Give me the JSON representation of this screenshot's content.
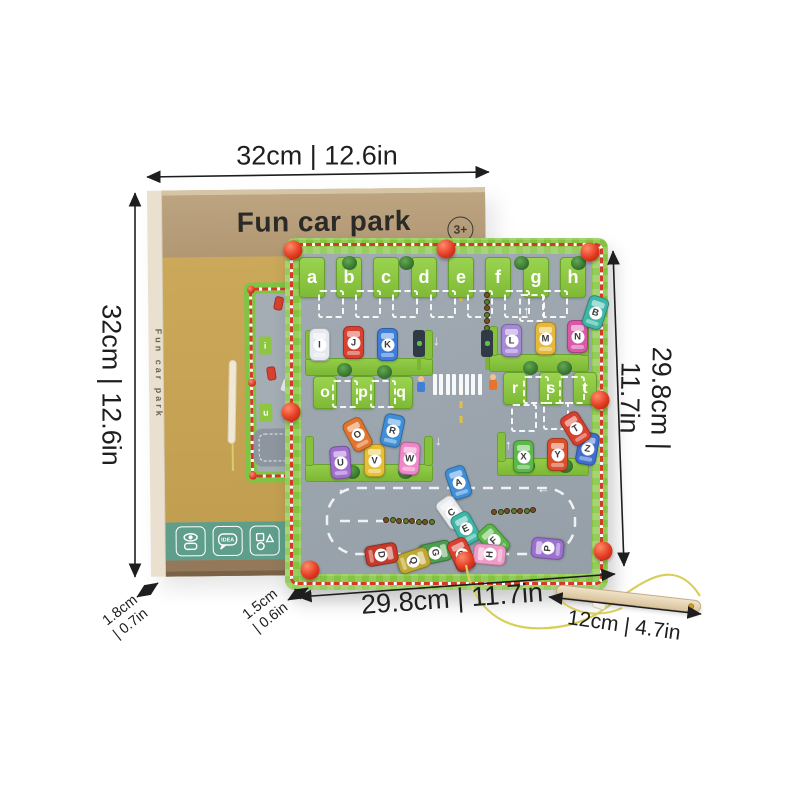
{
  "box": {
    "title": "Fun car park",
    "side_title": "Fun car park",
    "age_badge": "3+",
    "mini_board_letters": [
      "i",
      "u"
    ],
    "icons": [
      {
        "name": "eye-and-toy-icon"
      },
      {
        "name": "idea-bubble-icon",
        "label": "IDEA"
      },
      {
        "name": "shapes-icon"
      },
      {
        "name": "math-symbols-icon",
        "line1": "+ −",
        "line2": "× ÷"
      }
    ]
  },
  "dimensions": {
    "width_top": "32cm | 12.6in",
    "height_left": "32cm | 12.6in",
    "board_height_right": "29.8cm | 11.7in",
    "board_width_bottom": "29.8cm | 11.7in",
    "wand_length": "12cm | 4.7in",
    "box_depth": "1.8cm\n| 0.7in",
    "board_depth": "1.5cm\n| 0.6in"
  },
  "board": {
    "top_letters": [
      "a",
      "b",
      "c",
      "d",
      "e",
      "f",
      "g",
      "h"
    ],
    "left_slot_letters": [
      "o",
      "p",
      "q"
    ],
    "right_slot_letters": [
      "r",
      "s",
      "t"
    ],
    "cars": [
      {
        "letter": "I",
        "color": "#e6e9ef",
        "x": 24,
        "y": 90,
        "rot": 0
      },
      {
        "letter": "J",
        "color": "#d8412f",
        "x": 58,
        "y": 88,
        "rot": 0
      },
      {
        "letter": "K",
        "color": "#3f7ed8",
        "x": 92,
        "y": 90,
        "rot": 0
      },
      {
        "letter": "L",
        "color": "#a78ad6",
        "x": 216,
        "y": 86,
        "rot": 0
      },
      {
        "letter": "M",
        "color": "#e7b93b",
        "x": 250,
        "y": 84,
        "rot": 0
      },
      {
        "letter": "N",
        "color": "#d958a9",
        "x": 282,
        "y": 82,
        "rot": 0
      },
      {
        "letter": "U",
        "color": "#a06ecf",
        "x": 45,
        "y": 208,
        "rot": -4
      },
      {
        "letter": "V",
        "color": "#e7c133",
        "x": 79,
        "y": 206,
        "rot": 0
      },
      {
        "letter": "W",
        "color": "#ef87c8",
        "x": 114,
        "y": 204,
        "rot": 4
      },
      {
        "letter": "X",
        "color": "#5cb84a",
        "x": 228,
        "y": 202,
        "rot": 0
      },
      {
        "letter": "Y",
        "color": "#d9512c",
        "x": 262,
        "y": 200,
        "rot": 0
      },
      {
        "letter": "Z",
        "color": "#3f6ed0",
        "x": 292,
        "y": 194,
        "rot": 10
      },
      {
        "letter": "O",
        "color": "#e0762e",
        "x": 62,
        "y": 180,
        "rot": -28
      },
      {
        "letter": "R",
        "color": "#3f8ed8",
        "x": 97,
        "y": 176,
        "rot": 12
      },
      {
        "letter": "T",
        "color": "#d8402e",
        "x": 280,
        "y": 174,
        "rot": -32
      },
      {
        "letter": "B",
        "color": "#3fb7a7",
        "x": 300,
        "y": 58,
        "rot": 18
      },
      {
        "letter": "A",
        "color": "#3f8ed8",
        "x": 163,
        "y": 228,
        "rot": -18
      },
      {
        "letter": "C",
        "color": "#e8ebee",
        "x": 156,
        "y": 258,
        "rot": -35
      },
      {
        "letter": "E",
        "color": "#3fb7a7",
        "x": 170,
        "y": 274,
        "rot": -28
      },
      {
        "letter": "F",
        "color": "#5cb84a",
        "x": 198,
        "y": 286,
        "rot": -42
      },
      {
        "letter": "G",
        "color": "#4a9e4e",
        "x": 140,
        "y": 298,
        "rot": 78
      },
      {
        "letter": "S",
        "color": "#d8412f",
        "x": 166,
        "y": 300,
        "rot": -25
      },
      {
        "letter": "H",
        "color": "#ef9bc8",
        "x": 194,
        "y": 300,
        "rot": -85
      },
      {
        "letter": "Q",
        "color": "#bfa733",
        "x": 118,
        "y": 306,
        "rot": 72
      },
      {
        "letter": "D",
        "color": "#c53a2a",
        "x": 86,
        "y": 300,
        "rot": 80
      },
      {
        "letter": "P",
        "color": "#9b70cf",
        "x": 252,
        "y": 294,
        "rot": -85
      }
    ]
  },
  "colors": {
    "board_green": "#84c340",
    "frame_dash_red": "#d23b24",
    "asphalt": "#9aa4ac",
    "kraft_box": "#b59c78",
    "mustard_panel": "#c8a455",
    "teal_band": "#5f9e8b",
    "pin_red": "#e03420",
    "wand_wood": "#e7d5b4",
    "string_yellow": "#d8cf5a",
    "dimension_text": "#1e1e1e"
  }
}
